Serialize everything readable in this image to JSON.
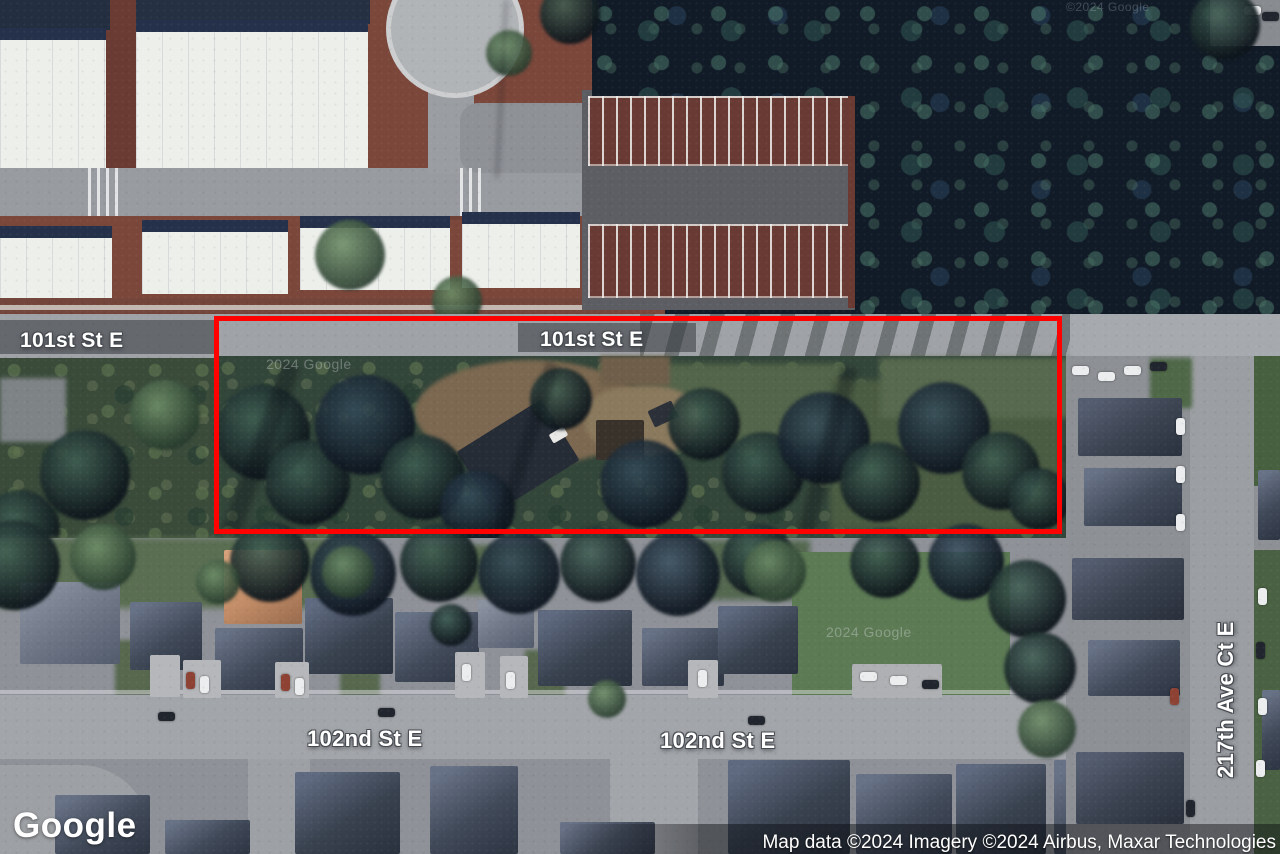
{
  "map": {
    "labels": {
      "street_101_left": "101st St E",
      "street_101_center": "101st St E",
      "street_102_left": "102nd St E",
      "street_102_right": "102nd St E",
      "street_217": "217th Ave Ct E"
    },
    "watermarks": {
      "w1": "2024 Google",
      "w2": "2024 Google",
      "w3": "©2024 Google"
    },
    "annotation": {
      "type": "rectangle",
      "color": "#ff0200"
    }
  },
  "footer": {
    "logo": "Google",
    "attribution": "Map data ©2024 Imagery ©2024 Airbus, Maxar Technologies"
  }
}
